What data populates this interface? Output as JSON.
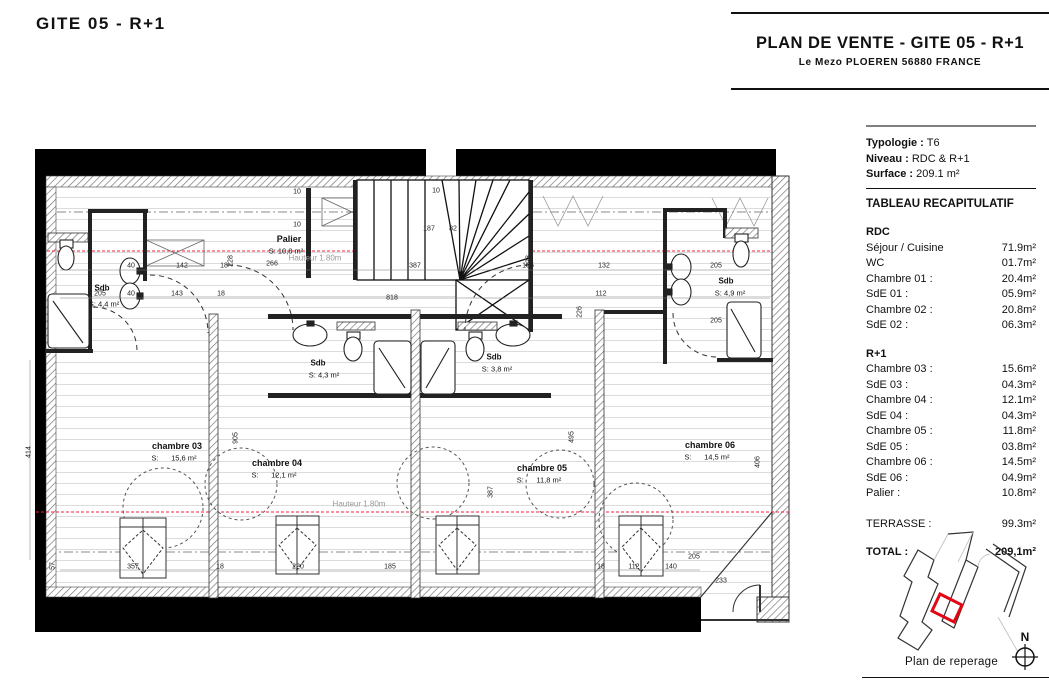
{
  "sheet": {
    "title": "GITE 05 - R+1"
  },
  "header": {
    "title": "PLAN DE VENTE - GITE 05 - R+1",
    "subtitle": "Le Mezo PLOEREN 56880 FRANCE"
  },
  "info": {
    "typologie_label": "Typologie :",
    "typologie": "T6",
    "niveau_label": "Niveau :",
    "niveau": "RDC & R+1",
    "surface_label": "Surface :",
    "surface": "209.1 m²",
    "table_title": "TABLEAU RECAPITULATIF"
  },
  "recap": {
    "rdc": {
      "title": "RDC",
      "rows": [
        {
          "label": "Séjour / Cuisine",
          "value": "71.9m²"
        },
        {
          "label": "WC",
          "value": "01.7m²"
        },
        {
          "label": "Chambre 01 :",
          "value": "20.4m²"
        },
        {
          "label": "SdE 01 :",
          "value": "05.9m²"
        },
        {
          "label": "Chambre 02 :",
          "value": "20.8m²"
        },
        {
          "label": "SdE 02 :",
          "value": "06.3m²"
        }
      ]
    },
    "r1": {
      "title": "R+1",
      "rows": [
        {
          "label": "Chambre 03 :",
          "value": "15.6m²"
        },
        {
          "label": "SdE 03 :",
          "value": "04.3m²"
        },
        {
          "label": "Chambre 04 :",
          "value": "12.1m²"
        },
        {
          "label": "SdE 04 :",
          "value": "04.3m²"
        },
        {
          "label": "Chambre 05 :",
          "value": "11.8m²"
        },
        {
          "label": "SdE 05 :",
          "value": "03.8m²"
        },
        {
          "label": "Chambre 06 :",
          "value": "14.5m²"
        },
        {
          "label": "SdE 06 :",
          "value": "04.9m²"
        },
        {
          "label": "Palier :",
          "value": "10.8m²"
        }
      ]
    },
    "terrasse": {
      "label": "TERRASSE :",
      "value": "99.3m²"
    },
    "total": {
      "label": "TOTAL :",
      "value": "209,1m²"
    }
  },
  "reperage": {
    "caption": "Plan de reperage",
    "north_label": "N",
    "highlight_color": "#e30613"
  },
  "plan": {
    "height_note": "Hauteur 1.80m",
    "rooms": [
      {
        "name": "Palier",
        "area": "S: 10,8 m²"
      },
      {
        "name": "Sdb",
        "area": "S: 4,4 m²"
      },
      {
        "name": "Sdb",
        "area": "S: 4,3 m²"
      },
      {
        "name": "Sdb",
        "area": "S: 3,8 m²"
      },
      {
        "name": "Sdb",
        "area": "S: 4,9 m²"
      },
      {
        "name": "chambre 03",
        "area": "S:      15,6 m²"
      },
      {
        "name": "chambre 04",
        "area": "S:      12,1 m²"
      },
      {
        "name": "chambre 05",
        "area": "S:      11,8 m²"
      },
      {
        "name": "chambre 06",
        "area": "S:      14,5 m²"
      }
    ],
    "dims": [
      "40",
      "142",
      "18",
      "266",
      "387",
      "165",
      "132",
      "205",
      "40",
      "143",
      "18",
      "818",
      "112",
      "205",
      "205",
      "187",
      "82",
      "10",
      "10",
      "10",
      "357",
      "18",
      "220",
      "185",
      "18",
      "112",
      "140",
      "205",
      "233",
      "414",
      "57",
      "905",
      "228",
      "228",
      "226",
      "495",
      "387",
      "406"
    ],
    "colors": {
      "red_line": "#f2233b",
      "wall": "#000000"
    }
  }
}
